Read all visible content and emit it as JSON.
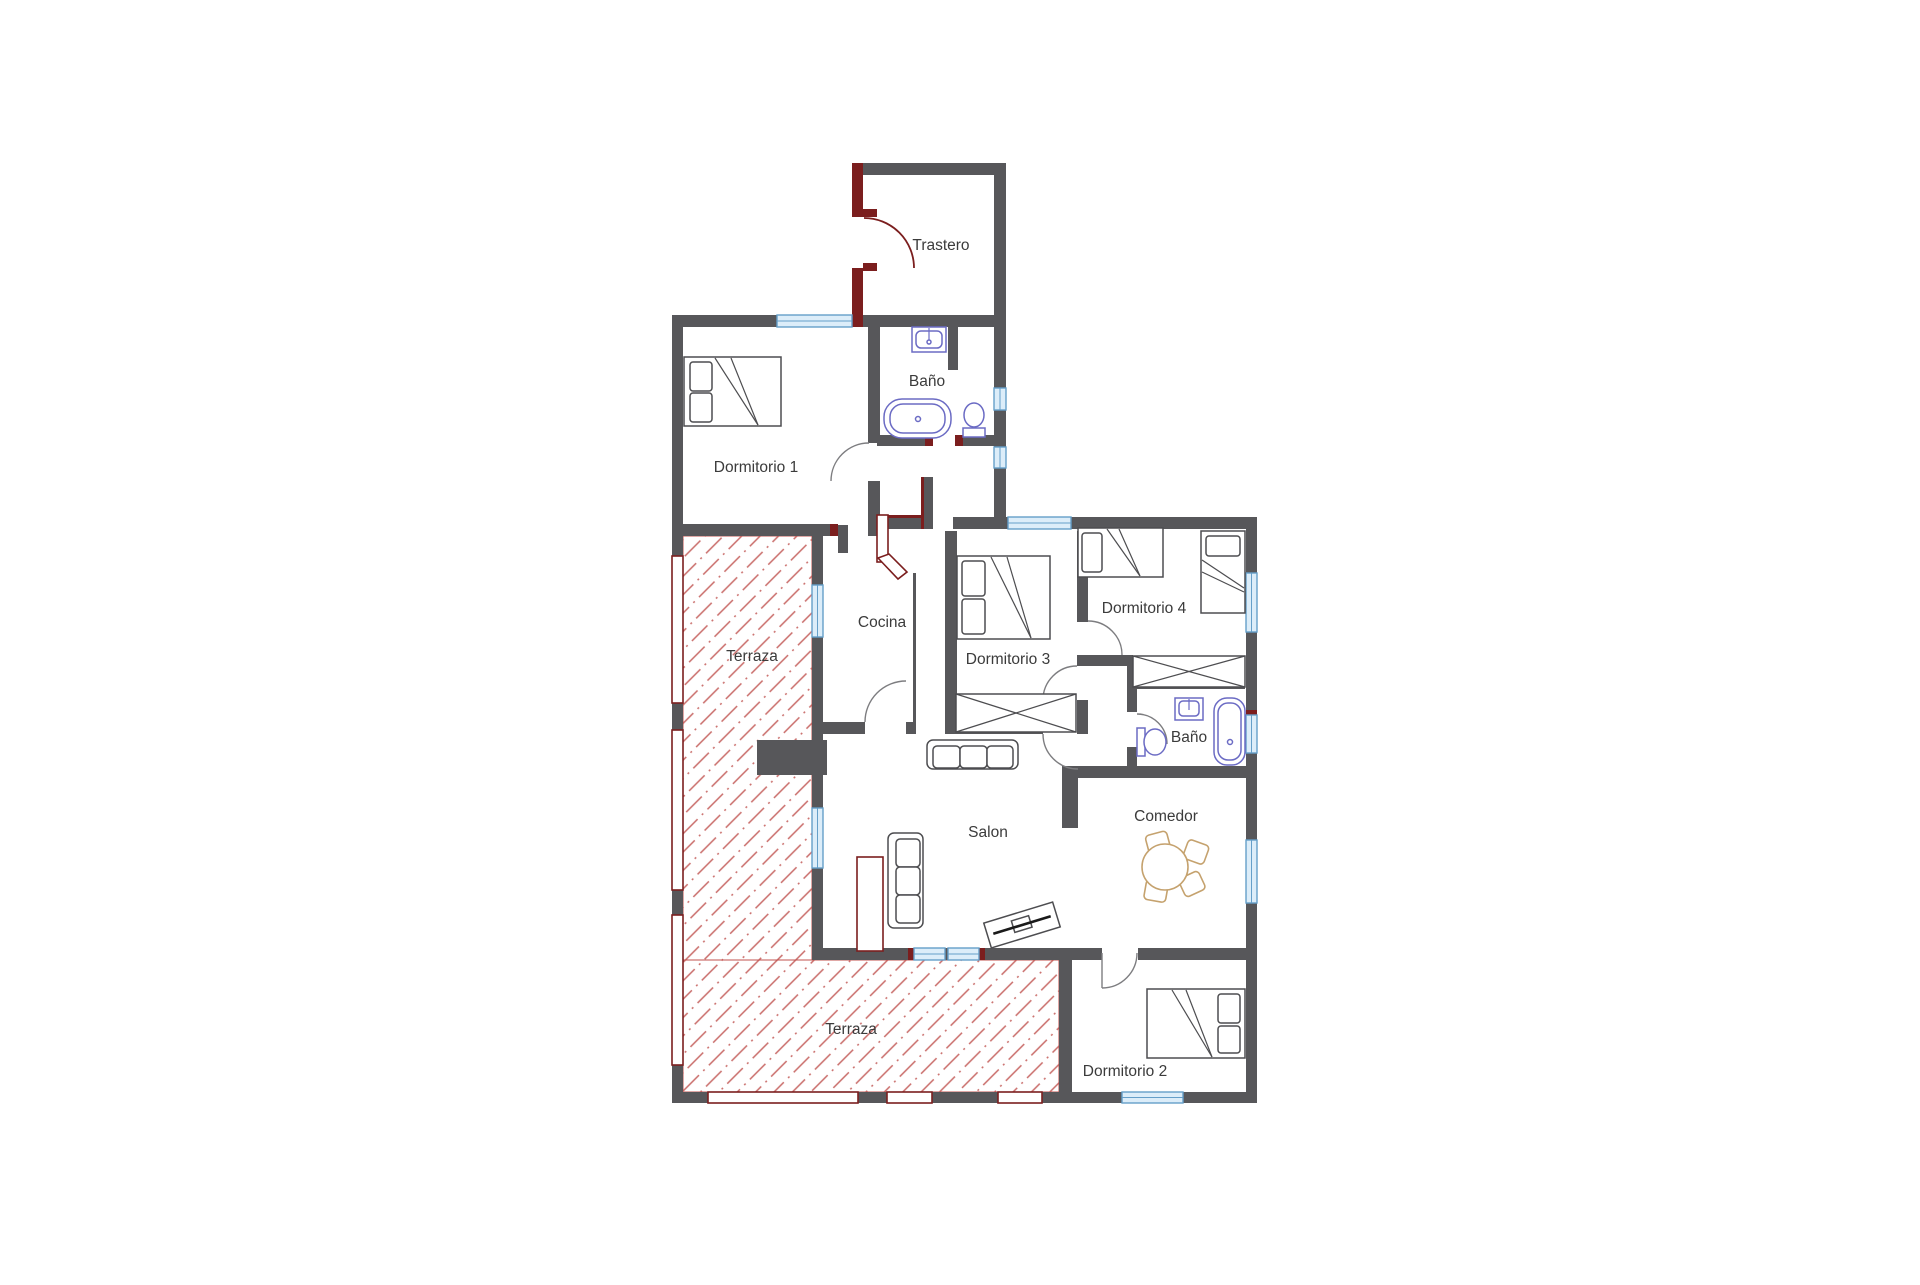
{
  "plan": {
    "type": "floor-plan",
    "background": "#ffffff",
    "colors": {
      "wall": "#57575a",
      "accent": "#7b1e1e",
      "hatch": "#c0524e",
      "window_fill": "#dcedf9",
      "window_stroke": "#659fc9",
      "fixture": "#6b6bc4",
      "furniture": "#4d4d50",
      "dining": "#c5a26e",
      "label": "#3b3b3b"
    },
    "rooms": [
      {
        "id": "trastero",
        "label": "Trastero"
      },
      {
        "id": "bano-1",
        "label": "Baño"
      },
      {
        "id": "dormitorio-1",
        "label": "Dormitorio  1"
      },
      {
        "id": "terraza-1",
        "label": "Terraza"
      },
      {
        "id": "cocina",
        "label": "Cocina"
      },
      {
        "id": "dormitorio-3",
        "label": "Dormitorio 3"
      },
      {
        "id": "dormitorio-4",
        "label": "Dormitorio 4"
      },
      {
        "id": "bano-2",
        "label": "Baño"
      },
      {
        "id": "comedor",
        "label": "Comedor"
      },
      {
        "id": "salon",
        "label": "Salon"
      },
      {
        "id": "terraza-2",
        "label": "Terraza"
      },
      {
        "id": "dormitorio-2",
        "label": "Dormitorio 2"
      }
    ],
    "fixtures": [
      "bed-icon",
      "bed-icon",
      "bed-icon",
      "bed-icon",
      "bed-icon",
      "wardrobe-icon",
      "wardrobe-icon",
      "sofa-icon",
      "sofa-icon",
      "tv-unit-icon",
      "fireplace-icon",
      "dining-table-icon",
      "chair-icon",
      "bathtub-icon",
      "bathtub-icon",
      "sink-icon",
      "sink-icon",
      "toilet-icon",
      "toilet-icon",
      "window-icon",
      "door-arc-icon",
      "railing-icon",
      "terrace-hatch-icon"
    ]
  }
}
